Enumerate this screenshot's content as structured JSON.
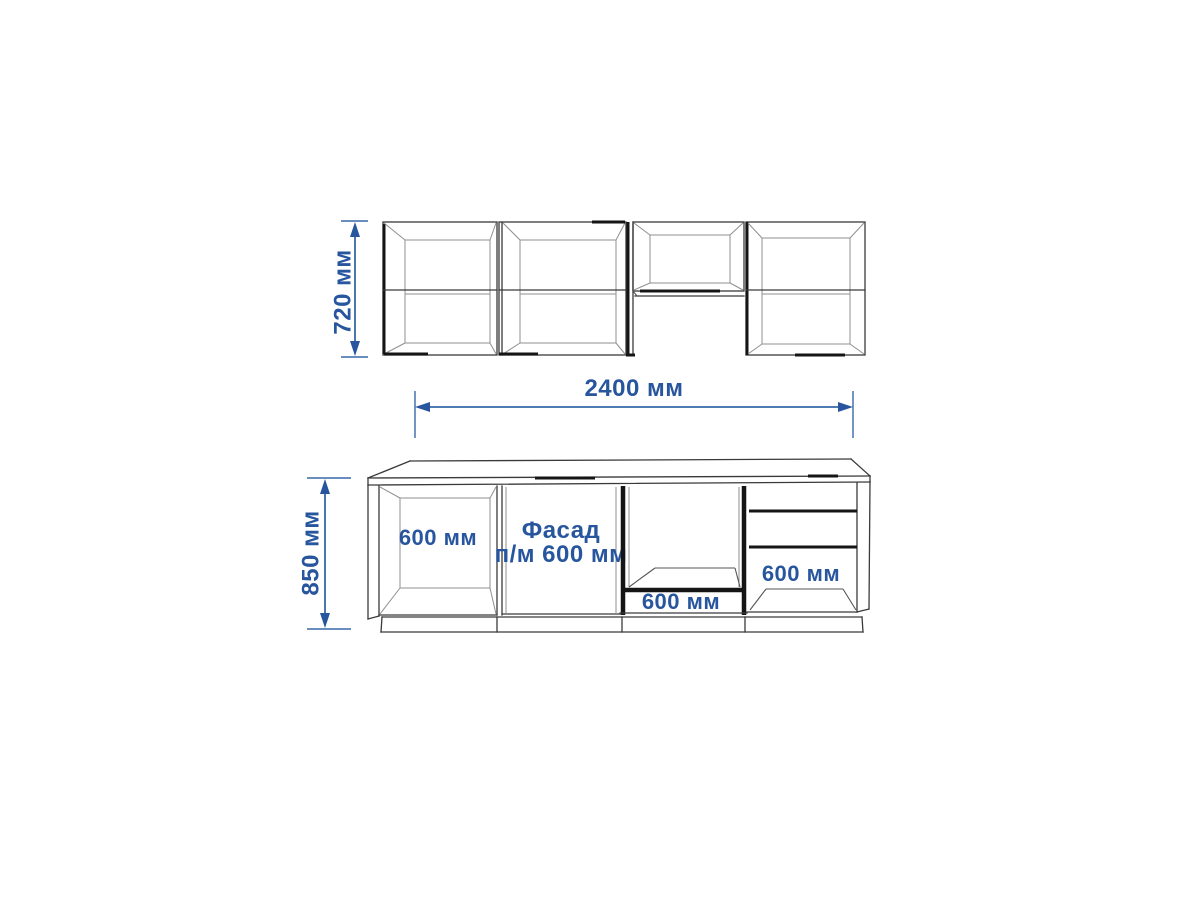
{
  "page": {
    "background": "#ffffff"
  },
  "colors": {
    "accent_blue": "#27559e",
    "dimension_line_blue": "#3568a8",
    "drawing_line": "#3a3a3a",
    "drawing_line_dark": "#151515"
  },
  "dimensions": {
    "upper_cabinet_height": "720 мм",
    "kitchen_width": "2400 мм",
    "base_cabinet_height": "850 мм"
  },
  "cabinet_labels": {
    "open_base_cabinet_width": "600 мм",
    "facade_line1": "Фасад",
    "facade_line2": "п/м 600 мм",
    "oven_cabinet_width": "600 мм",
    "drawer_cabinet_width": "600 мм"
  }
}
